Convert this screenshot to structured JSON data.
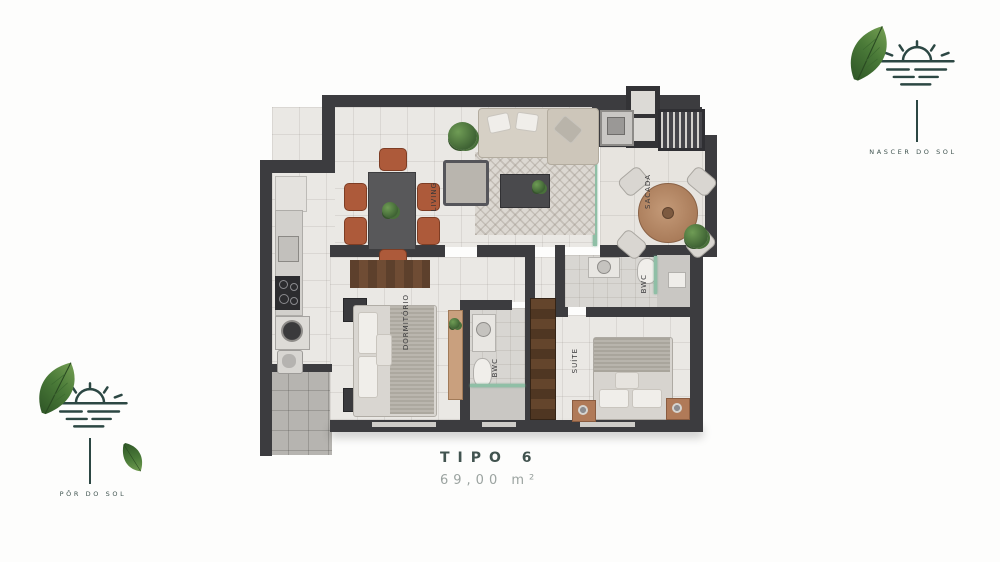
{
  "title": {
    "name": "TIPO 6",
    "area": "69,00 m²"
  },
  "logos": {
    "top_right": {
      "label": "NASCER DO SOL"
    },
    "bottom_left": {
      "label": "PÔR DO SOL"
    }
  },
  "rooms": {
    "living": {
      "label": "LIVING"
    },
    "sacada": {
      "label": "SACADA"
    },
    "bwc_suite": {
      "label": "BWC"
    },
    "bwc_social": {
      "label": "BWC"
    },
    "dormitorio": {
      "label": "DORMITÓRIO"
    },
    "suite": {
      "label": "SUÍTE"
    }
  },
  "colors": {
    "wall": "#3c3c3f",
    "logo_teal": "#2c4743",
    "terracotta": "#ad5a3a",
    "wood": "#b5886a",
    "plant_green": "#4c7a45",
    "title_dark": "#41534f",
    "title_muted": "#9ba3a0"
  }
}
